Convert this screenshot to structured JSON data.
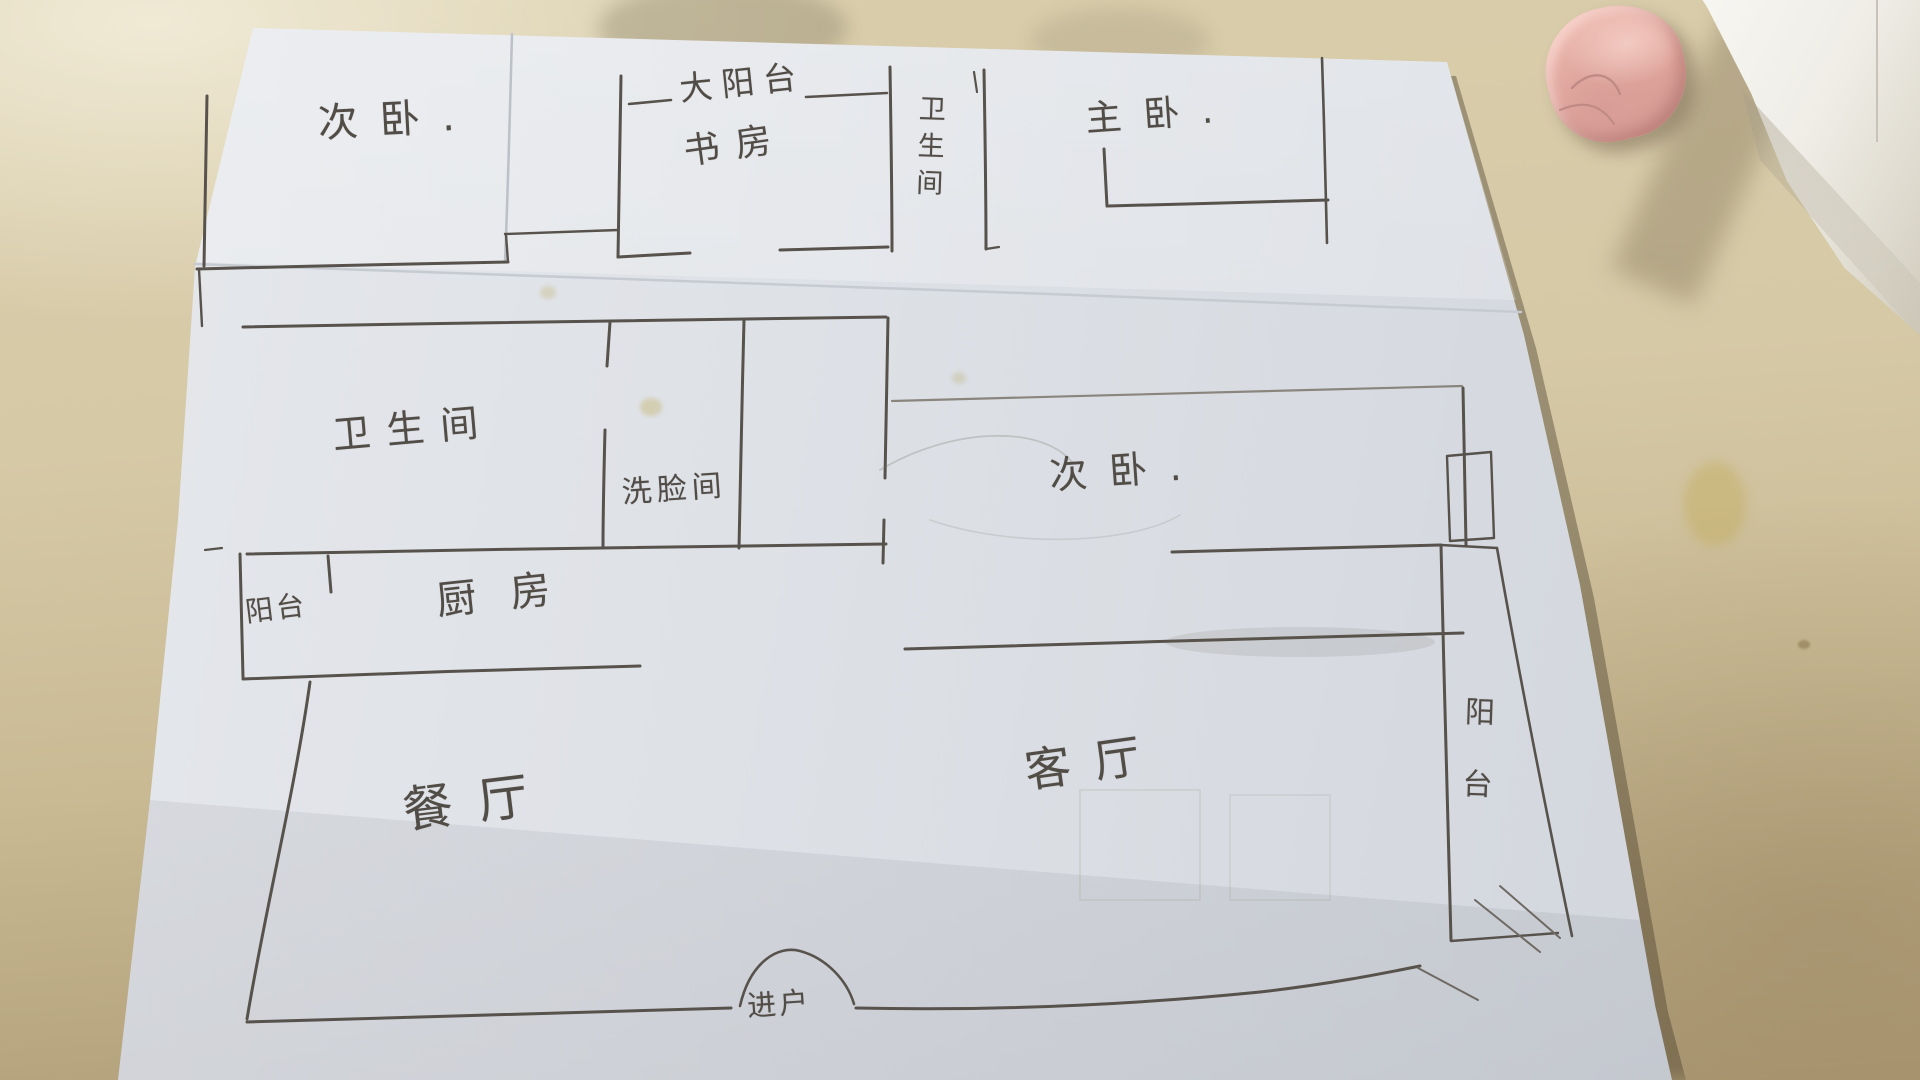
{
  "floor_plan": {
    "rooms": {
      "bedroom_top_left": "次卧.",
      "big_balcony": "大阳台",
      "study": "书房",
      "bathroom_top": "卫生间",
      "master_bedroom": "主卧.",
      "bathroom_mid": "卫生间",
      "washroom": "洗脸间",
      "bedroom_mid_right": "次卧.",
      "balcony_left": "阳台",
      "kitchen": "厨房",
      "dining_room": "餐厅",
      "living_room": "客厅",
      "balcony_right": "阳台",
      "entrance": "进户"
    },
    "colors": {
      "ink": "#55504a",
      "paper": "#dfe2e6",
      "table": "#d2c5a3",
      "eraser_pink": "#e9b6ae"
    }
  }
}
